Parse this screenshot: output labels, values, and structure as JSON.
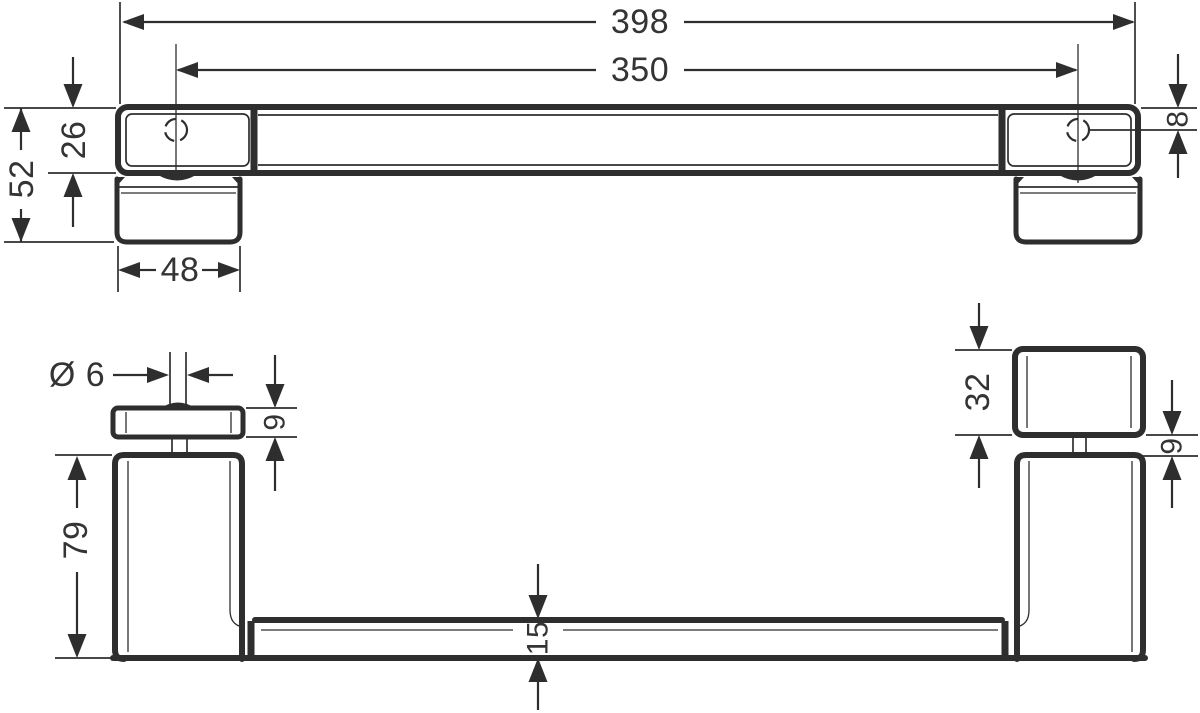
{
  "drawing": {
    "kind": "technical-dimension-drawing",
    "line_color": "#2e2e2e",
    "background_color": "#ffffff",
    "text_color": "#343434"
  },
  "dims": {
    "overall_length": "398",
    "mounting_distance": "350",
    "overall_depth": "52",
    "bar_depth": "26",
    "plate_width": "48",
    "edge_to_hole": "8",
    "pin_diameter": "Ø 6",
    "plate_thickness_left": "9",
    "post_height": "79",
    "block_height": "32",
    "plate_thickness_right": "9",
    "rail_thickness": "15"
  }
}
